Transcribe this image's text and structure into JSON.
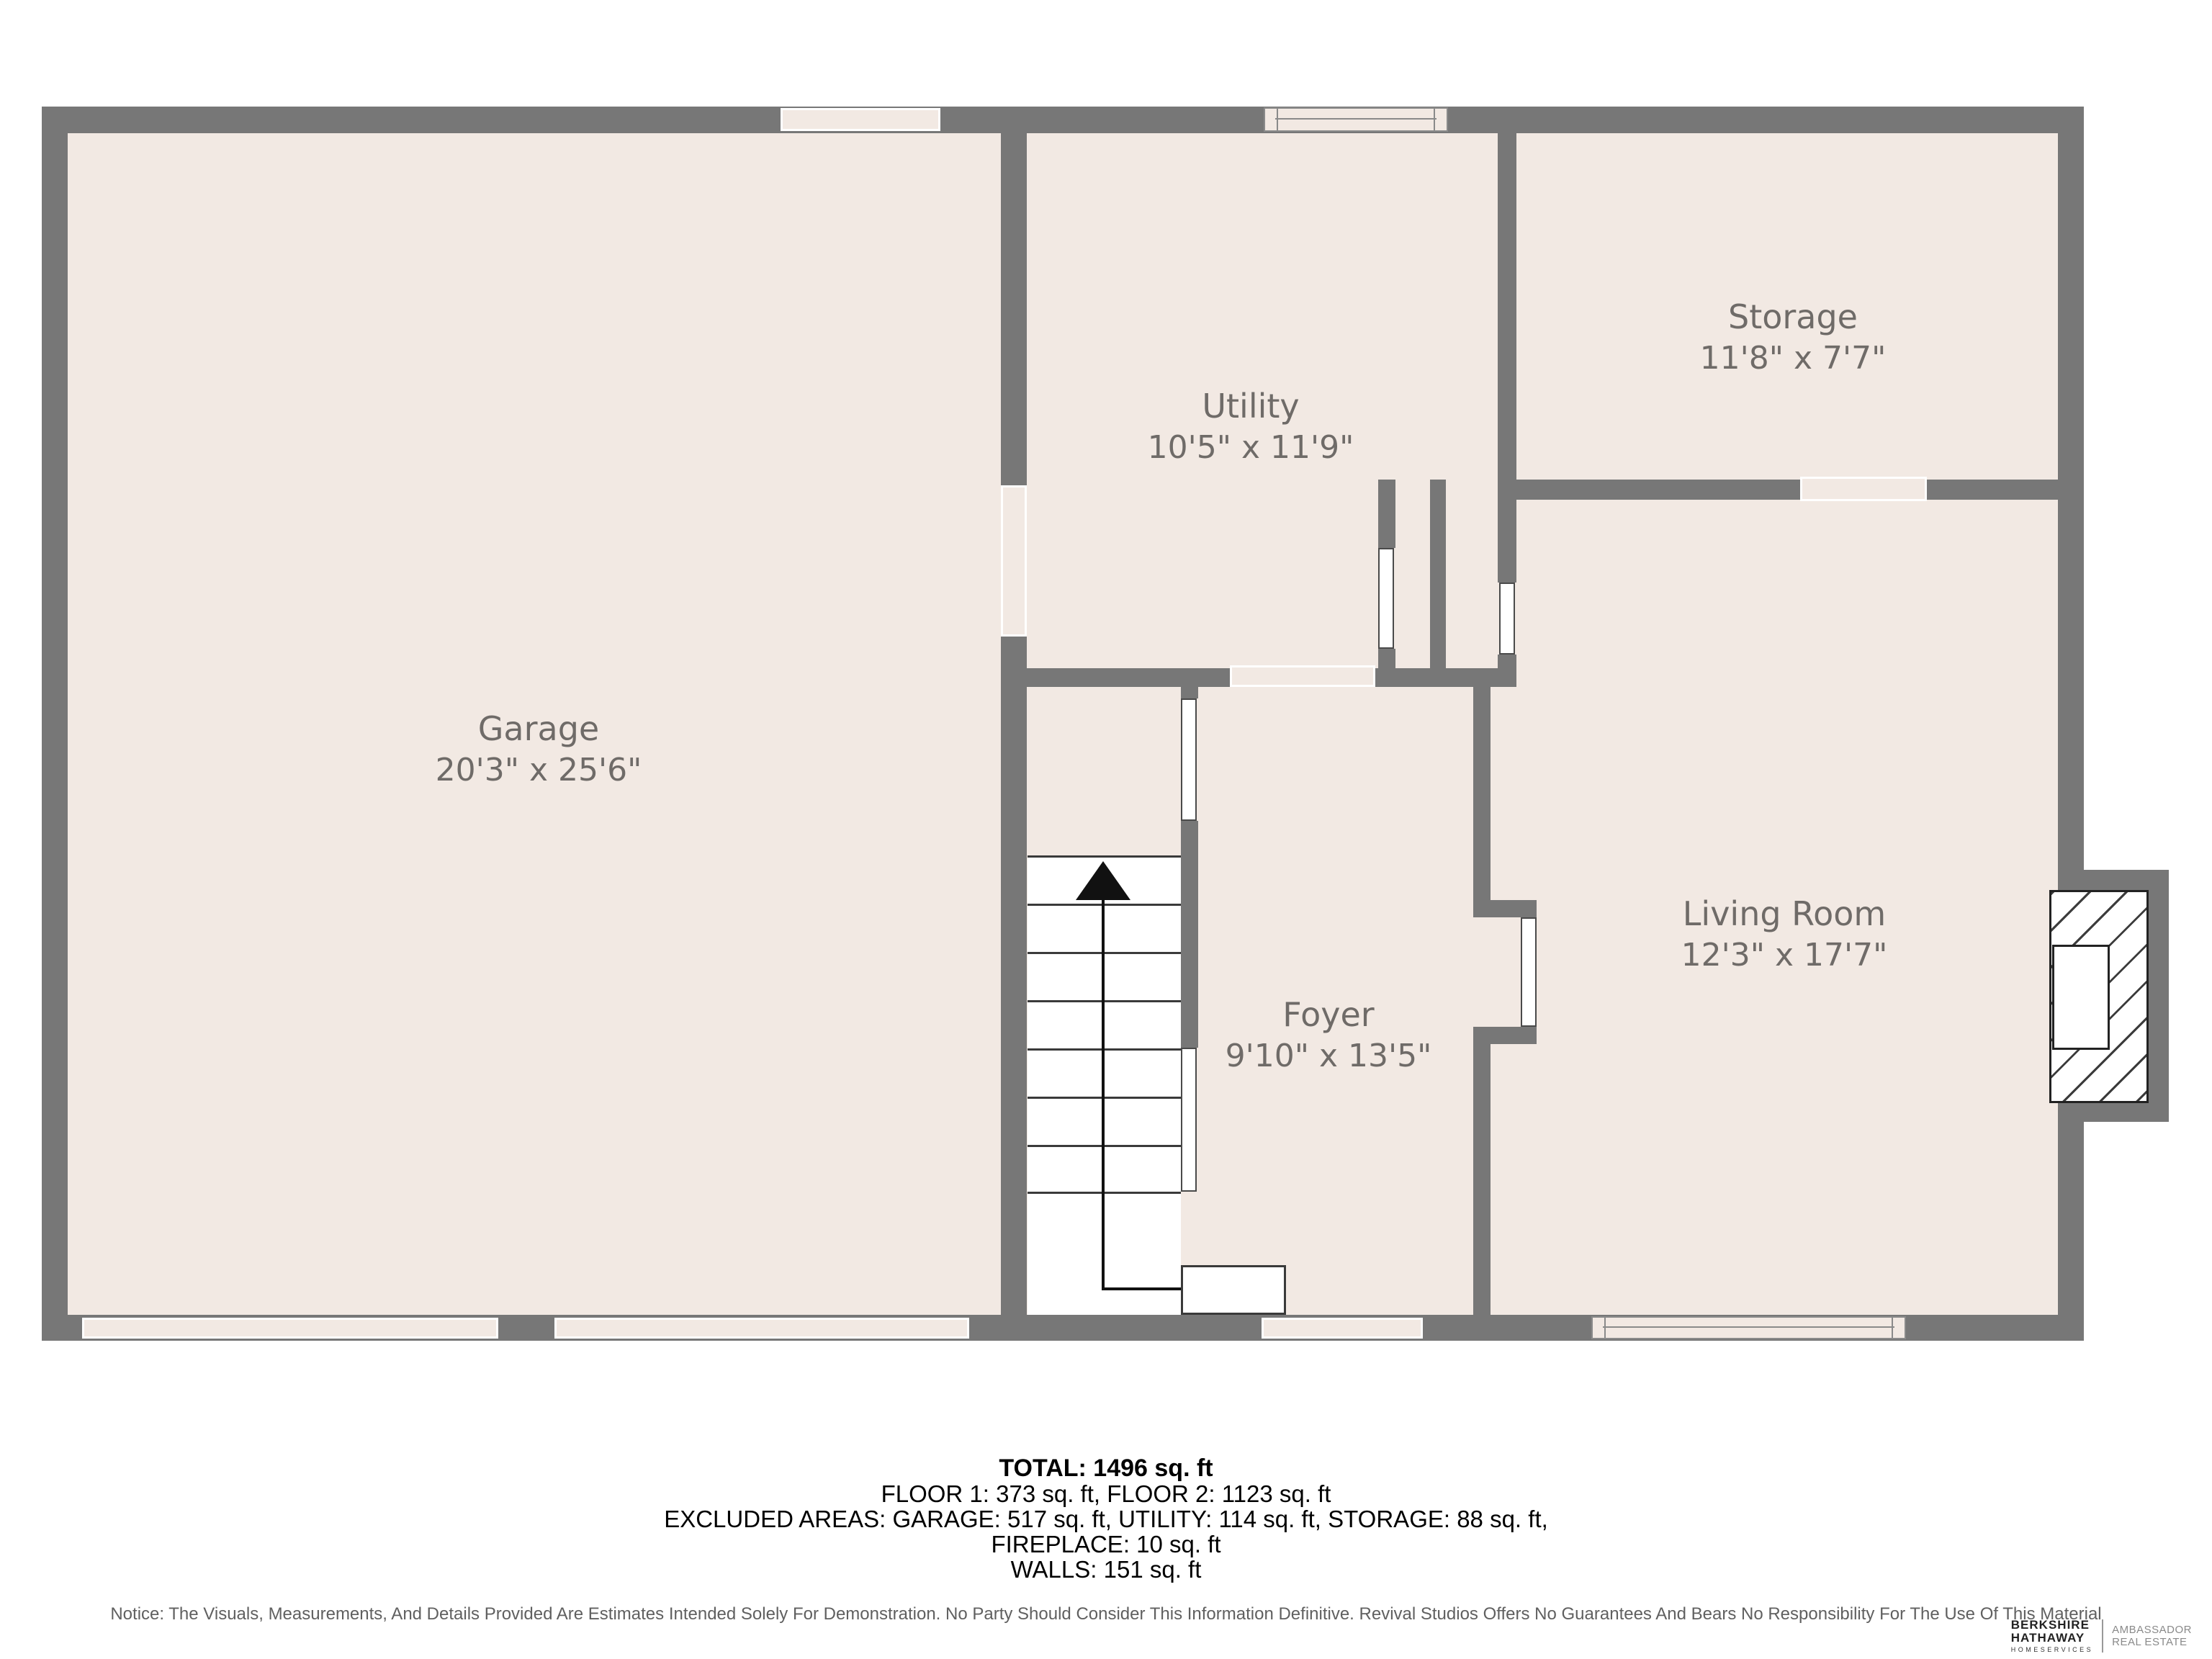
{
  "palette": {
    "wall": "#777777",
    "floor": "#f2e9e3",
    "label": "#6f6b68",
    "stair_line": "#3a3a3a",
    "window_line": "#8a8a8a"
  },
  "rooms": {
    "garage": {
      "name": "Garage",
      "dims": "20'3\" x 25'6\""
    },
    "utility": {
      "name": "Utility",
      "dims": "10'5\" x 11'9\""
    },
    "storage": {
      "name": "Storage",
      "dims": "11'8\" x 7'7\""
    },
    "foyer": {
      "name": "Foyer",
      "dims": "9'10\" x 13'5\""
    },
    "living_room": {
      "name": "Living Room",
      "dims": "12'3\" x 17'7\""
    }
  },
  "summary": {
    "total": "TOTAL: 1496 sq. ft",
    "floors": "FLOOR 1: 373 sq. ft, FLOOR 2: 1123 sq. ft",
    "excluded": "EXCLUDED AREAS: GARAGE: 517 sq. ft, UTILITY: 114 sq. ft, STORAGE: 88 sq. ft,",
    "fireplace": "FIREPLACE: 10 sq. ft",
    "walls": "WALLS: 151 sq. ft"
  },
  "notice": "Notice: The Visuals, Measurements, And Details Provided Are Estimates Intended Solely For Demonstration. No Party Should Consider This Information Definitive. Revival Studios Offers No Guarantees And Bears No Responsibility For The Use Of This Material",
  "logo": {
    "brand_top": "BERKSHIRE",
    "brand_bottom": "HATHAWAY",
    "brand_sub": "HOMESERVICES",
    "agency_line1": "AMBASSADOR",
    "agency_line2": "REAL ESTATE"
  }
}
